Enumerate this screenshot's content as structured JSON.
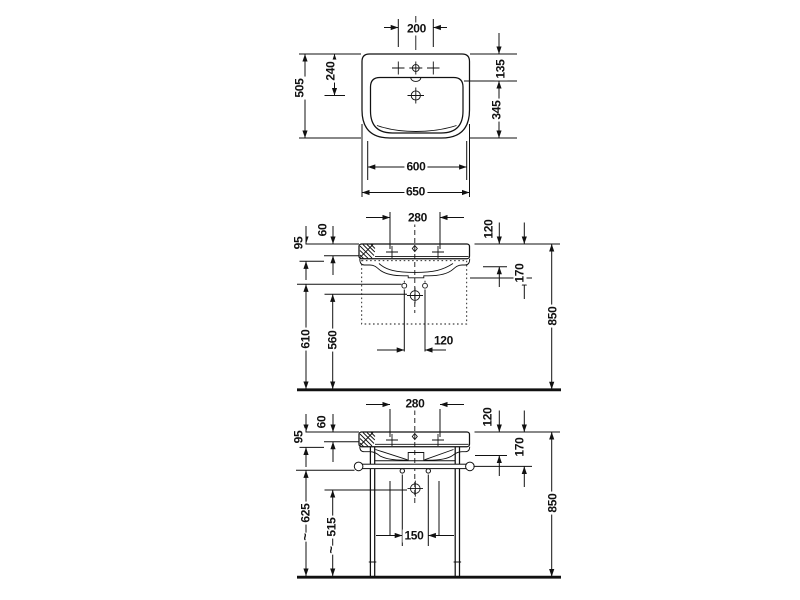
{
  "drawing": {
    "colors": {
      "line": "#111111",
      "background": "#ffffff"
    },
    "views": [
      {
        "name": "washbasin-plan-view",
        "dims": {
          "tap_hole_spacing": "200",
          "overall_depth": "505",
          "front_edge_to_drain": "240",
          "rear_ledge_depth": "135",
          "bowl_depth": "345",
          "basin_width": "600",
          "overall_width": "650"
        }
      },
      {
        "name": "washbasin-front-view-wall-mounted",
        "dims": {
          "tap_hole_spacing": "280",
          "rim_step": "60",
          "rim_thickness": "95",
          "fixing_hole_height": "610",
          "drain_height": "560",
          "fixing_hole_spacing": "120",
          "front_drop": "120",
          "apron_drop": "170",
          "rim_height": "850"
        }
      },
      {
        "name": "washbasin-front-view-console-legs",
        "dims": {
          "tap_hole_spacing": "280",
          "rim_step": "60",
          "rim_thickness": "95",
          "rail_height": "625",
          "rail_height_prefix": "~",
          "drain_height": "515",
          "drain_height_prefix": "~",
          "bolt_spacing": "150",
          "front_drop": "120",
          "apron_drop": "170",
          "rim_height": "850"
        }
      }
    ]
  }
}
